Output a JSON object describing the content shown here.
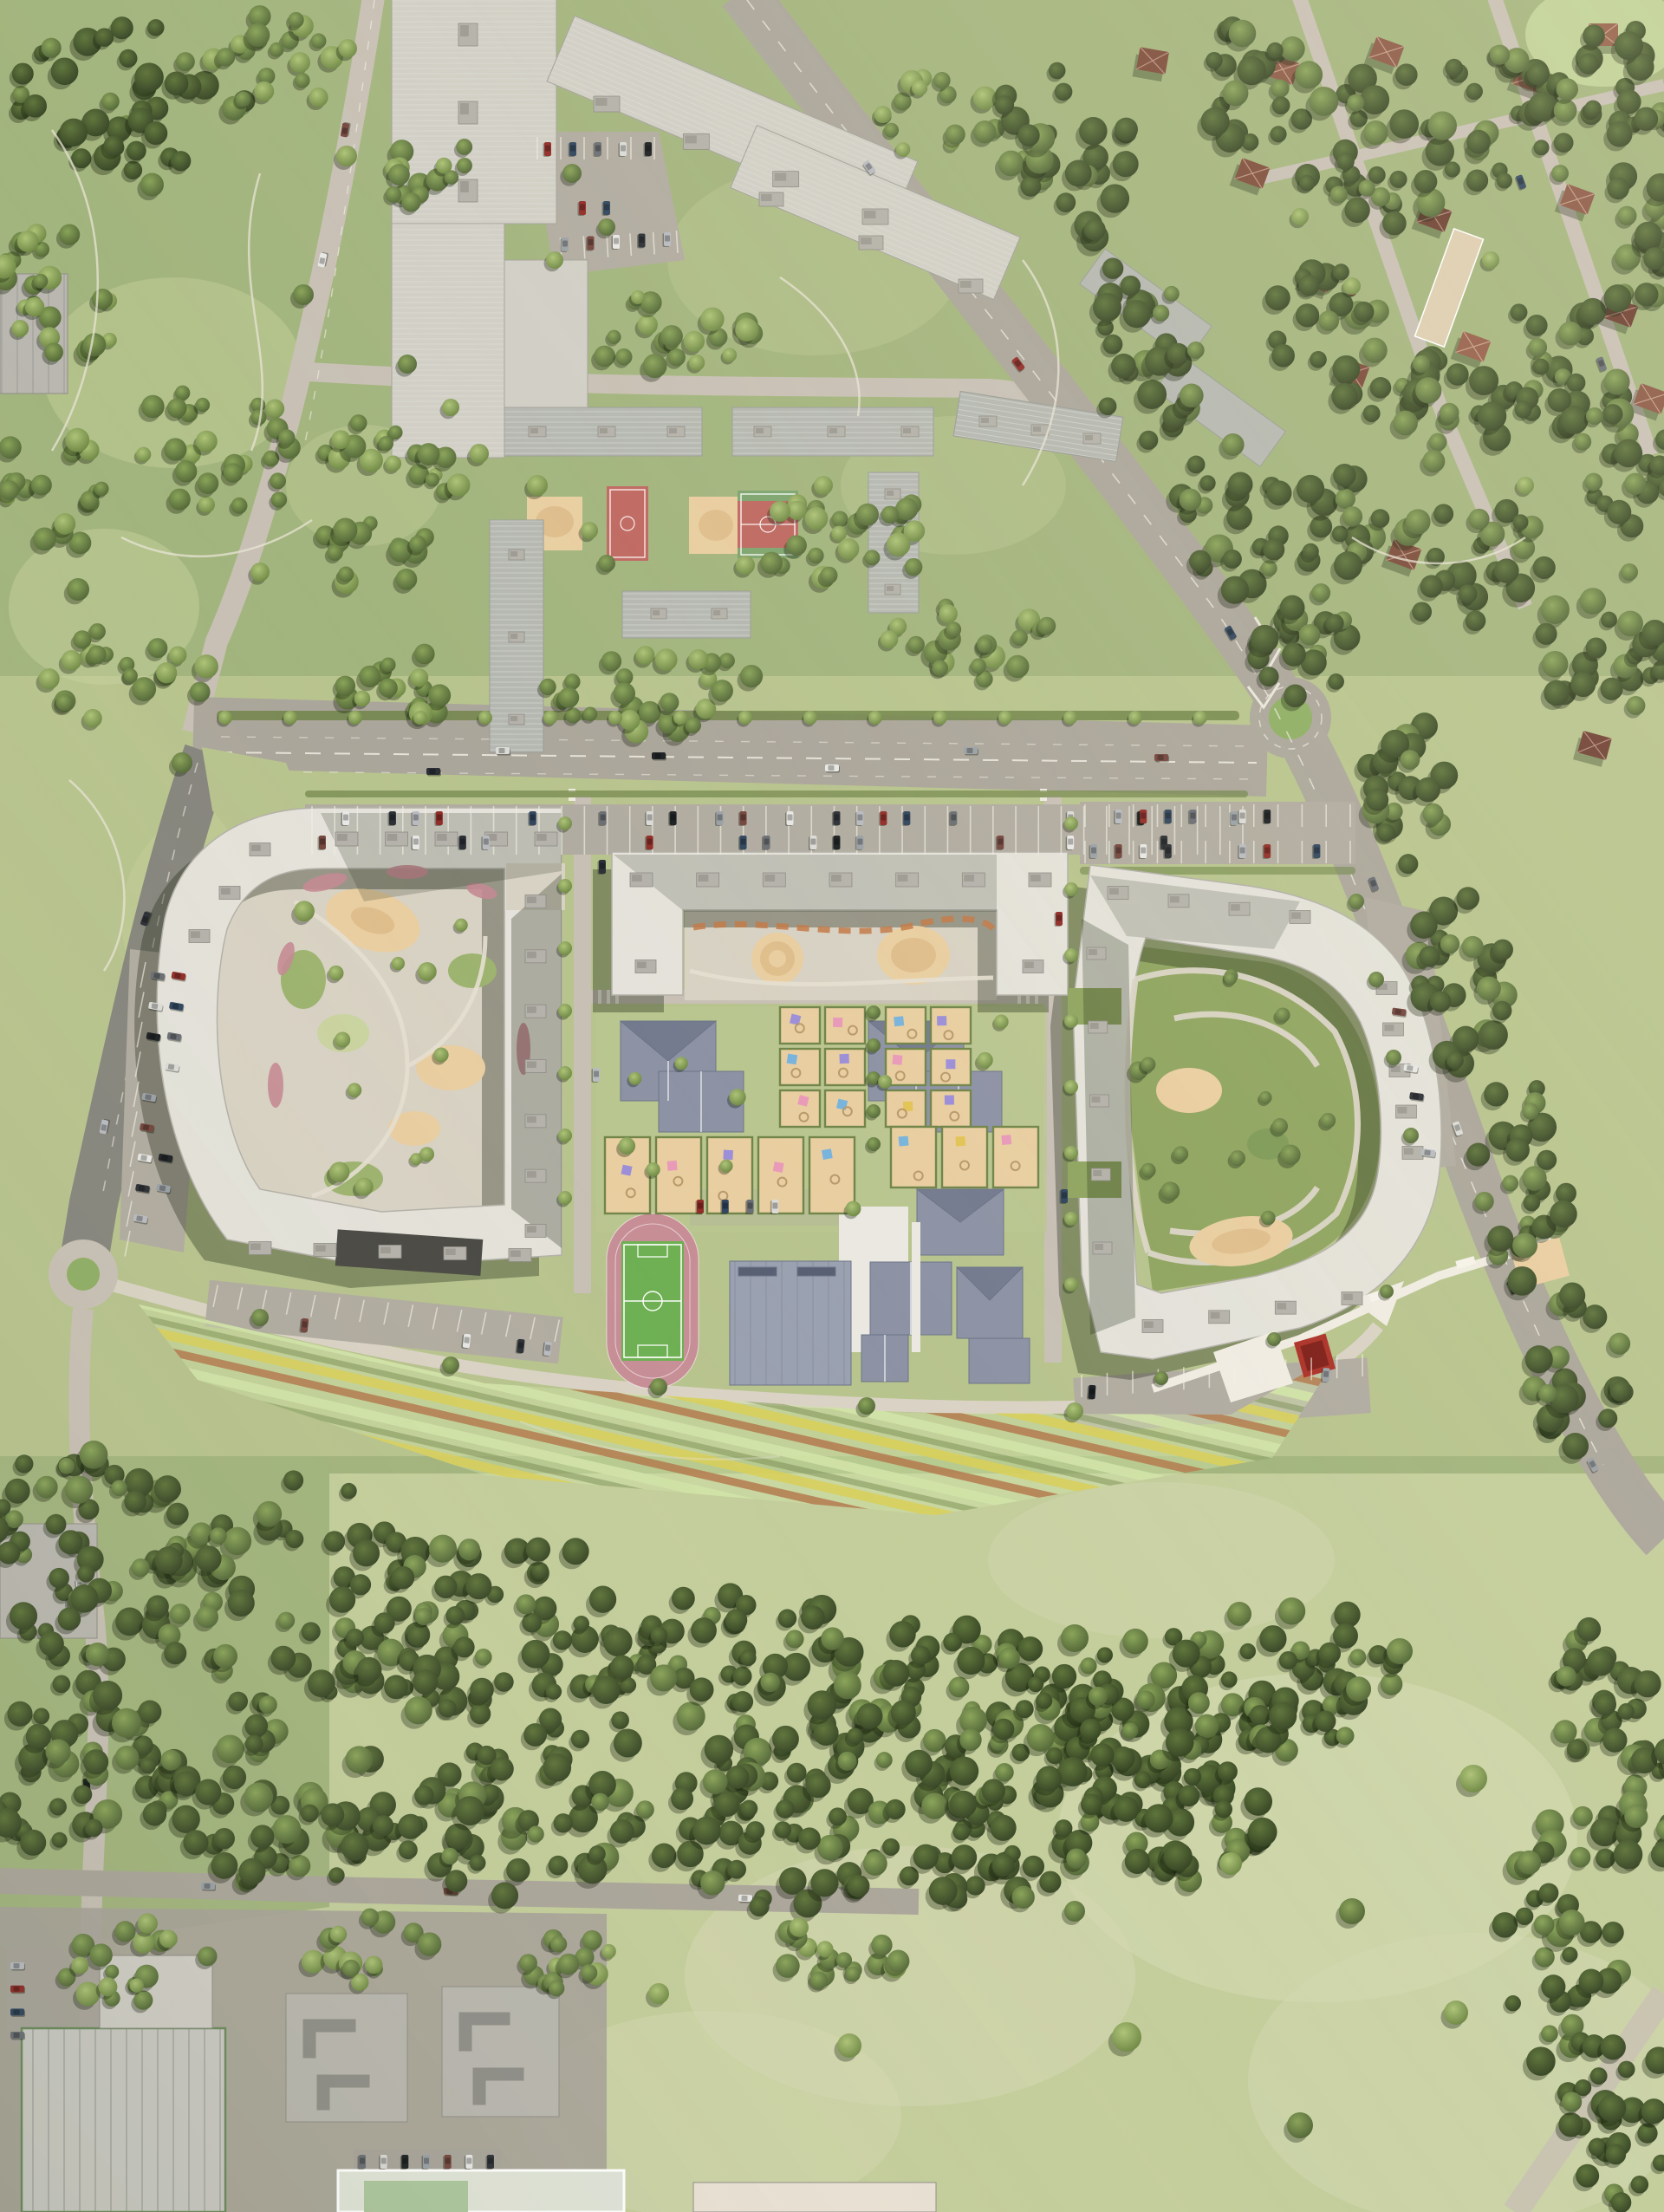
{
  "title": "Aerial render of residential masterplan with three new perimeter blocks, school, kindergarten, old housing estate, suburbs, park and forest belt",
  "palette": {
    "grass_park": "#a3b47f",
    "grass_light": "#b7c28f",
    "lawn_pale": "#c9d2a2",
    "meadow": "#c3cc9d",
    "meadow_pale": "#d6d9b6",
    "forest_dark": "#3f5231",
    "forest_mid": "#5b7040",
    "tree_light": "#7e9454",
    "road_main": "#aaa59b",
    "road_dark": "#87867e",
    "road_light": "#c6bfb4",
    "path_white": "#e8e4da",
    "parking_asphalt": "#b0aba1",
    "roof_white": "#e2e0d8",
    "roof_light": "#cfcdc5",
    "roof_mid": "#b8b6ae",
    "roof_old": "#b4b7b0",
    "roof_dark_section": "#4b4a45",
    "roof_slate": "#8d93a4",
    "roof_slate_dark": "#747b8e",
    "roof_brown": "#8a5a48",
    "roof_brown_dark": "#6e4236",
    "suburb_school_tan": "#dcccb2",
    "plaza_tan": "#d6d0c3",
    "sand": "#e6cda2",
    "sand_deep": "#dcbd8d",
    "court_red": "#bc6a63",
    "court_green": "#7fa470",
    "track_pink": "#c48e96",
    "pitch_green": "#6fae55",
    "stripe_yellow": "#d6cd5f",
    "stripe_rust": "#b07a50",
    "stripe_pale": "#cfe0a8",
    "flower_pink": "#c28b93",
    "flower_rust": "#c07a4a",
    "hedge_green": "#72854c",
    "roundabout_green": "#8fae67",
    "red_pavilion": "#a8342c",
    "shadow": "rgba(25,34,17,0.34)",
    "car_colors": [
      "#e6e6e4",
      "#2e3238",
      "#b7bac0",
      "#8e2f2a",
      "#33475f",
      "#6b6f75",
      "#d9d9d6",
      "#1f2326",
      "#9aa0a6",
      "#734740"
    ]
  },
  "legend": {
    "new_housing": "three white perimeter residential blocks with landscaped courtyards",
    "old_housing": "grey prefab slab estate with courtyard sport courts",
    "suburbs": "detached houses with brown hip roofs among trees",
    "education": [
      "school cluster with slate roofs",
      "kindergarten with fenced play plots"
    ],
    "sports": [
      "running track with football pitch",
      "sports hall",
      "basketball court",
      "multi-sport court"
    ],
    "landscape": [
      "city park",
      "forest belt",
      "meadow",
      "striped flower field"
    ],
    "transport": [
      "east-west boulevard",
      "diagonal arterial road",
      "roundabout",
      "perpendicular parking rows"
    ]
  }
}
